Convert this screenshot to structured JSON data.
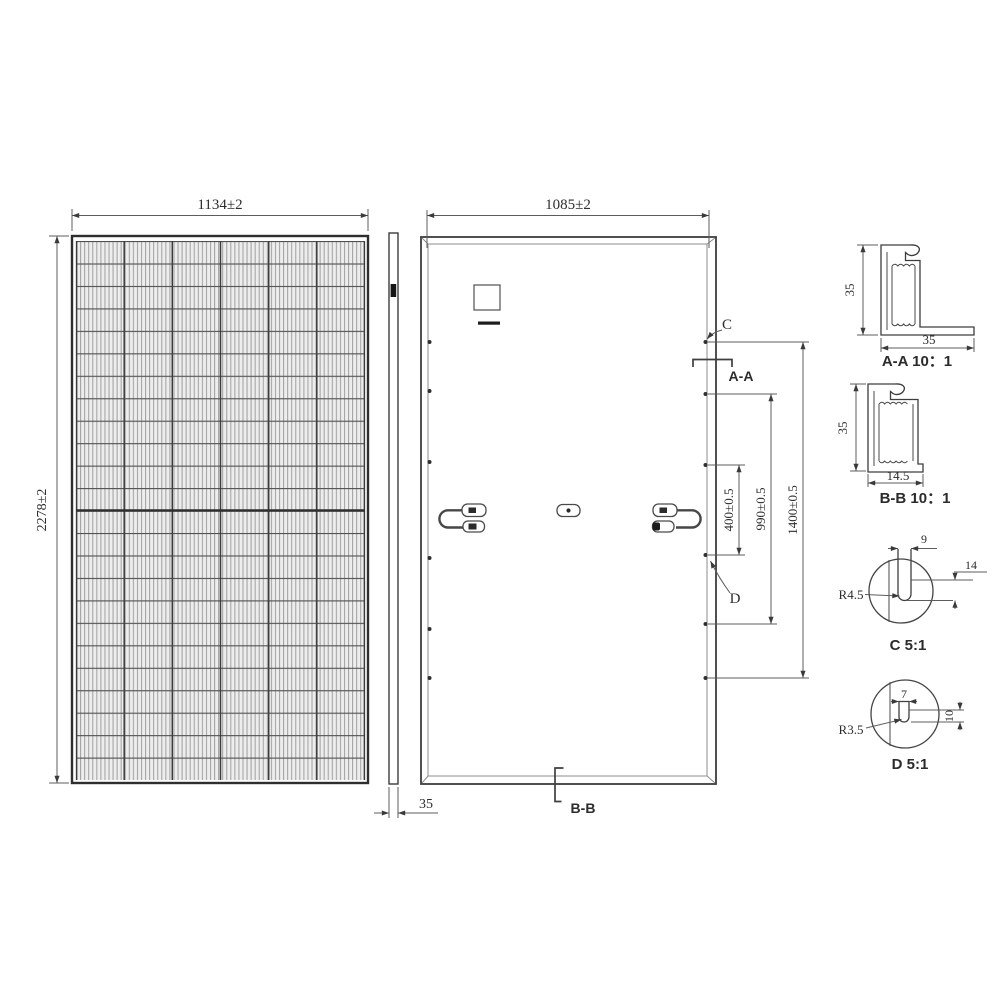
{
  "drawing_type": "solar-panel-engineering-drawing",
  "front_view": {
    "width_dim": "1134±2",
    "height_dim": "2278±2",
    "columns": 6,
    "rows": 24
  },
  "side_view": {
    "thickness_dim": "35"
  },
  "back_view": {
    "width_dim": "1085±2",
    "hole_pitch_inner": "400±0.5",
    "hole_pitch_middle": "990±0.5",
    "hole_pitch_outer": "1400±0.5",
    "section_a_label": "A-A",
    "section_b_label": "B-B",
    "detail_c_label": "C",
    "detail_d_label": "D"
  },
  "detail_views": {
    "aa": {
      "label": "A-A 10：1",
      "height_dim": "35",
      "width_dim": "35"
    },
    "bb": {
      "label": "B-B 10：1",
      "height_dim": "35",
      "width_dim": "14.5"
    },
    "c": {
      "label": "C 5:1",
      "radius_dim": "R4.5",
      "slot_width_dim": "9",
      "slot_length_dim": "14"
    },
    "d": {
      "label": "D 5:1",
      "radius_dim": "R3.5",
      "slot_width_dim": "7",
      "slot_length_dim": "10"
    }
  },
  "colors": {
    "outline": "#3d3d3d",
    "dim_line": "#5c5c5c",
    "cell_bg": "#ededed",
    "cell_hatch": "#a3a3a3"
  }
}
